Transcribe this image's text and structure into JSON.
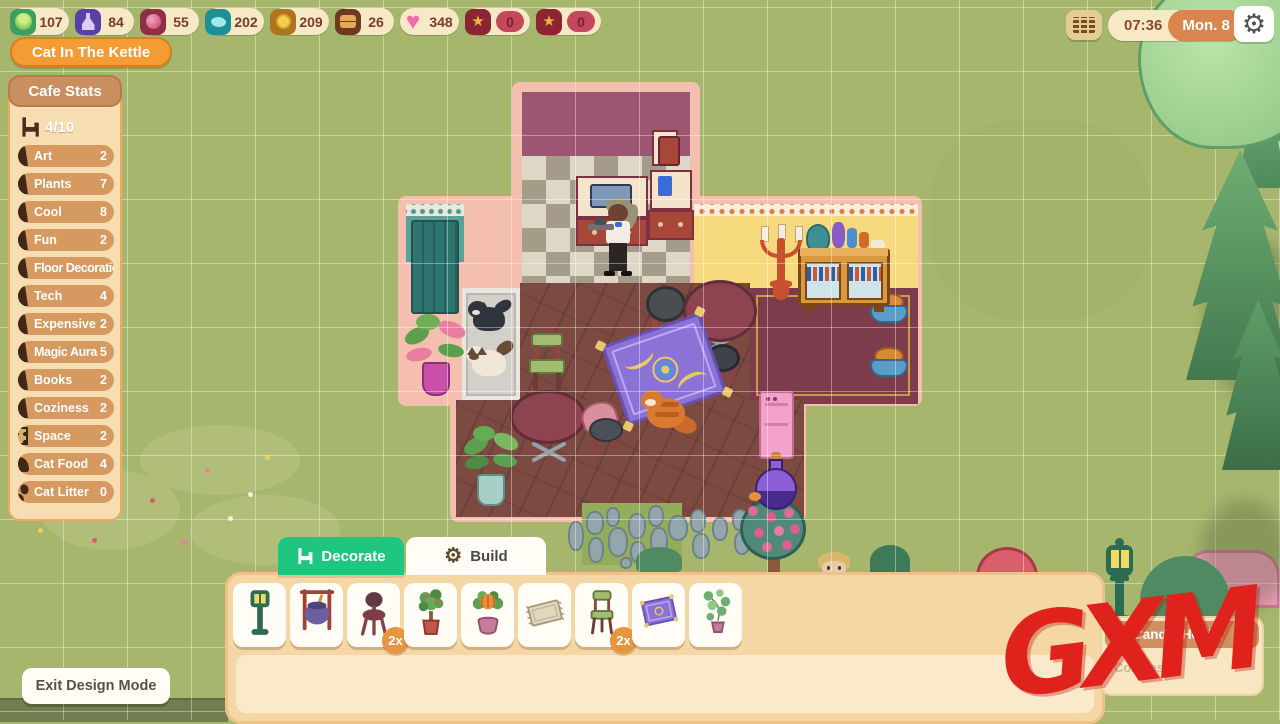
{
  "topbar": {
    "currencies": [
      {
        "name": "cabbage-icon",
        "value": "107"
      },
      {
        "name": "potion-icon",
        "value": "84"
      },
      {
        "name": "berry-icon",
        "value": "55"
      },
      {
        "name": "fish-icon",
        "value": "202"
      },
      {
        "name": "coin-icon",
        "value": "209"
      },
      {
        "name": "furniture-box-icon",
        "value": "26"
      },
      {
        "name": "heart-icon",
        "value": "348"
      },
      {
        "name": "paw-star-icon",
        "value": "0"
      },
      {
        "name": "star-badge-icon",
        "value": "0"
      }
    ],
    "time": "07:36",
    "date": "Mon. 8"
  },
  "cafe_name": "Cat In The Kettle",
  "cafe_stats": {
    "header": "Cafe Stats",
    "capacity": "4/10",
    "stats": [
      {
        "label": "Art",
        "value": "2",
        "icon": "decor-cone"
      },
      {
        "label": "Plants",
        "value": "7",
        "icon": "decor-cone"
      },
      {
        "label": "Cool",
        "value": "8",
        "icon": "decor-cone"
      },
      {
        "label": "Fun",
        "value": "2",
        "icon": "decor-cone"
      },
      {
        "label": "Floor Decoration",
        "value": "",
        "icon": "decor-cone"
      },
      {
        "label": "Tech",
        "value": "4",
        "icon": "decor-cone"
      },
      {
        "label": "Expensive",
        "value": "2",
        "icon": "decor-cone"
      },
      {
        "label": "Magic Aura",
        "value": "5",
        "icon": "decor-cone"
      },
      {
        "label": "Books",
        "value": "2",
        "icon": "decor-cone"
      },
      {
        "label": "Coziness",
        "value": "2",
        "icon": "decor-cone"
      },
      {
        "label": "Space",
        "value": "2",
        "icon": "rug-icon"
      },
      {
        "label": "Cat Food",
        "value": "4",
        "icon": "bowl-icon"
      },
      {
        "label": "Cat Litter",
        "value": "0",
        "icon": "paws-icon"
      }
    ]
  },
  "design_bar": {
    "decorate_tab": "Decorate",
    "build_tab": "Build",
    "items": [
      {
        "name": "lamp-post",
        "badge": ""
      },
      {
        "name": "cauldron",
        "badge": ""
      },
      {
        "name": "red-stool",
        "badge": "2x"
      },
      {
        "name": "potted-tree",
        "badge": ""
      },
      {
        "name": "pumpkin-plant",
        "badge": ""
      },
      {
        "name": "rug",
        "badge": ""
      },
      {
        "name": "green-chair",
        "badge": "2x"
      },
      {
        "name": "magic-carpet",
        "badge": ""
      },
      {
        "name": "vine-plant",
        "badge": ""
      }
    ]
  },
  "item_tooltip": {
    "title": "Candle Holder",
    "stat_label": "Coziness:",
    "icon": "chair-icon"
  },
  "exit_button": "Exit Design Mode",
  "watermark": "GXM",
  "colors": {
    "accent_orange": "#f49b33",
    "accent_green": "#1fc680",
    "panel_tan": "#f5d7a6",
    "grass": "#a6b76d",
    "frame_pink": "#f4bfae"
  }
}
